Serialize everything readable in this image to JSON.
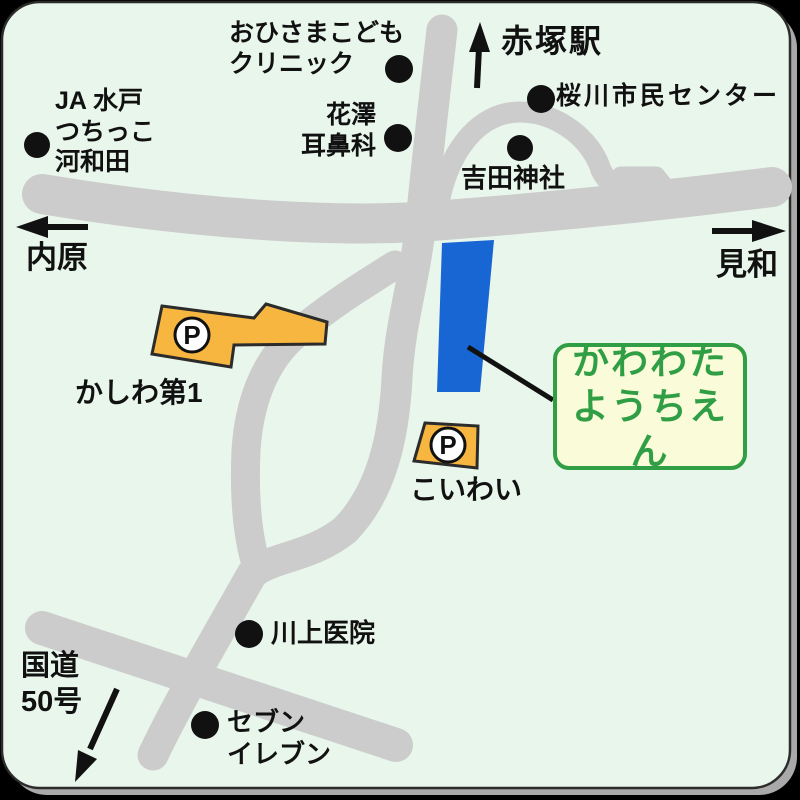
{
  "map": {
    "bg": "#e9f6ec",
    "road_color": "#cccccc",
    "outline_color": "#2b2b2b",
    "shadow_color": "#a9a9a9"
  },
  "directions": {
    "station": "赤塚駅",
    "west": "内原",
    "east": "見和",
    "route50": "国道\n50号"
  },
  "landmarks": {
    "clinic": "おひさまこども\nクリニック",
    "ja_mito": "JA 水戸\nつちっこ\n河和田",
    "hanazawa": "花澤\n耳鼻科",
    "sakuragawa_center": "桜川市民センター",
    "yoshida_shrine": "吉田神社",
    "kawakami_clinic": "川上医院",
    "seven_eleven": "セブン\nイレブン"
  },
  "parking": {
    "symbol": "P",
    "kashiwa_no1": "かしわ第1",
    "koiwai": "こいわい"
  },
  "destination": {
    "name": "かわわた\nようちえん",
    "building_color": "#1766d4",
    "box_bg": "#fafbd9",
    "accent_green": "#2f9e44"
  }
}
